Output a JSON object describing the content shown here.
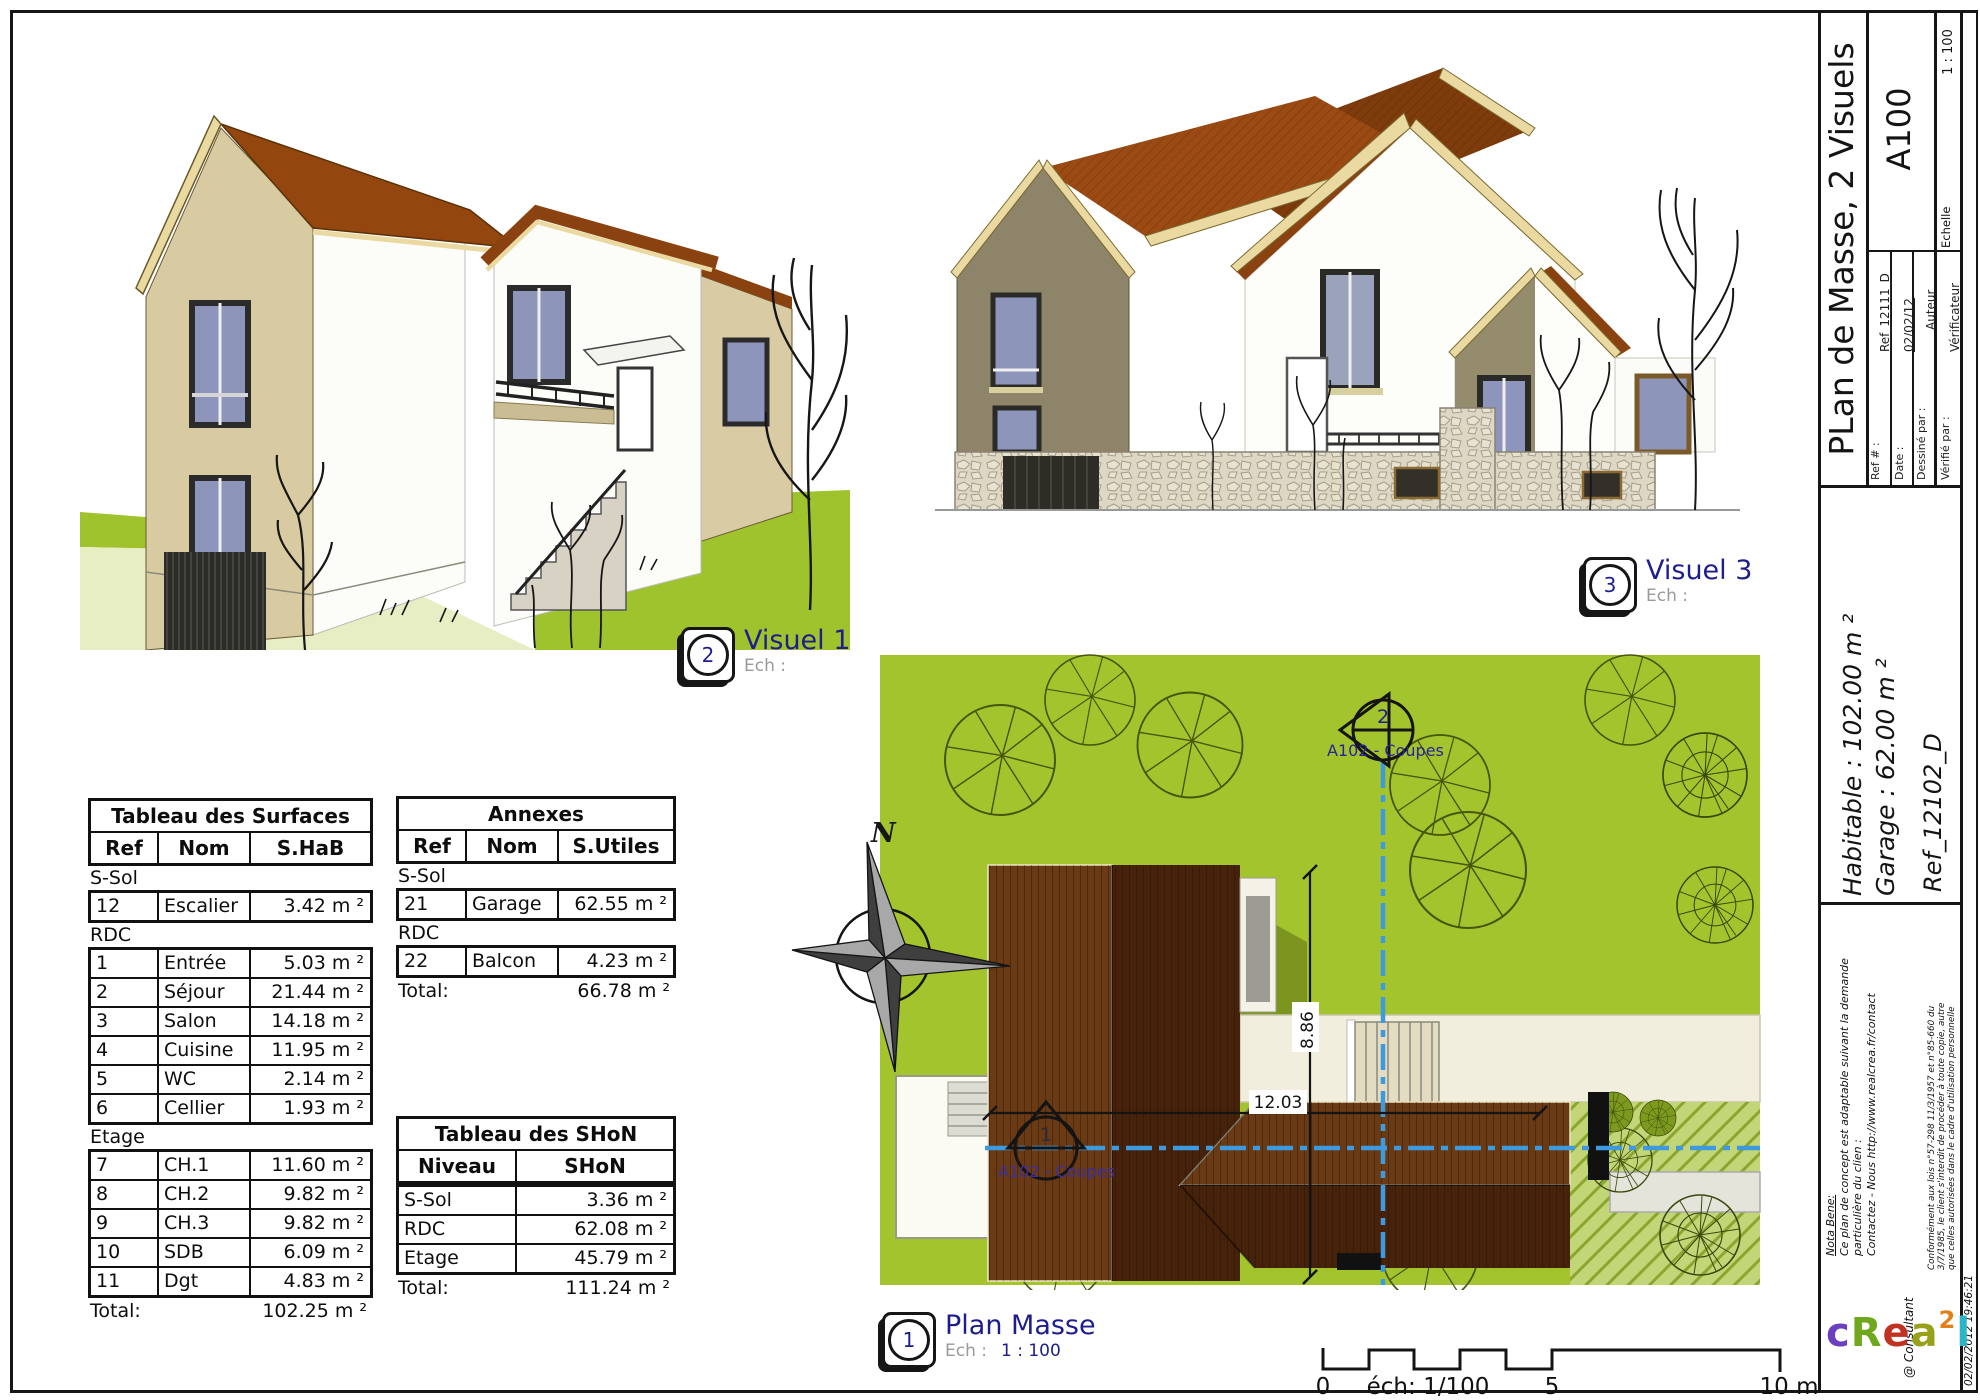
{
  "visual1": {
    "badge_num": "2",
    "title": "Visuel 1",
    "ech_label": "Ech :"
  },
  "visual3": {
    "badge_num": "3",
    "title": "Visuel 3",
    "ech_label": "Ech :"
  },
  "plan_label": {
    "badge_num": "1",
    "title": "Plan Masse",
    "ech_label": "Ech :",
    "scale": "1 : 100"
  },
  "plan": {
    "north": "N",
    "dim_vertical": "8.86",
    "dim_horizontal": "12.03",
    "section_top": {
      "num": "2",
      "label": "A102 - Coupes"
    },
    "section_left": {
      "num": "1",
      "label": "A102 - Coupes"
    }
  },
  "scale_bar": {
    "zero": "0",
    "caption": "éch: 1/100",
    "five": "5",
    "ten": "10 m"
  },
  "tables": {
    "surfaces": {
      "title": "Tableau des Surfaces",
      "headers": [
        "Ref",
        "Nom",
        "S.HaB"
      ],
      "groups": [
        {
          "label": "S-Sol",
          "rows": [
            [
              "12",
              "Escalier",
              "3.42 m ²"
            ]
          ]
        },
        {
          "label": "RDC",
          "rows": [
            [
              "1",
              "Entrée",
              "5.03 m ²"
            ],
            [
              "2",
              "Séjour",
              "21.44 m ²"
            ],
            [
              "3",
              "Salon",
              "14.18 m ²"
            ],
            [
              "4",
              "Cuisine",
              "11.95 m ²"
            ],
            [
              "5",
              "WC",
              "2.14 m ²"
            ],
            [
              "6",
              "Cellier",
              "1.93 m ²"
            ]
          ]
        },
        {
          "label": "Etage",
          "rows": [
            [
              "7",
              "CH.1",
              "11.60 m ²"
            ],
            [
              "8",
              "CH.2",
              "9.82 m ²"
            ],
            [
              "9",
              "CH.3",
              "9.82 m ²"
            ],
            [
              "10",
              "SDB",
              "6.09 m ²"
            ],
            [
              "11",
              "Dgt",
              "4.83 m ²"
            ]
          ]
        }
      ],
      "total_label": "Total:",
      "total_value": "102.25 m ²"
    },
    "annexes": {
      "title": "Annexes",
      "headers": [
        "Ref",
        "Nom",
        "S.Utiles"
      ],
      "groups": [
        {
          "label": "S-Sol",
          "rows": [
            [
              "21",
              "Garage",
              "62.55 m ²"
            ]
          ]
        },
        {
          "label": "RDC",
          "rows": [
            [
              "22",
              "Balcon",
              "4.23 m ²"
            ]
          ]
        }
      ],
      "total_label": "Total:",
      "total_value": "66.78 m ²"
    },
    "shon": {
      "title": "Tableau des SHoN",
      "headers": [
        "Niveau",
        "SHoN"
      ],
      "rows": [
        [
          "S-Sol",
          "3.36 m ²"
        ],
        [
          "RDC",
          "62.08 m ²"
        ],
        [
          "Etage",
          "45.79 m ²"
        ]
      ],
      "total_label": "Total:",
      "total_value": "111.24 m ²"
    }
  },
  "title_block": {
    "sheet_title": "PLan de Masse, 2 Visuels",
    "sheet_code": "A100",
    "ref_label": "Ref # :",
    "ref_value": "Ref_12111_D",
    "date_label": "Date :",
    "date_value": "02/02/12",
    "drawn_label": "Dessiné par :",
    "drawn_value": "Auteur",
    "checked_label": "Vérifié par :",
    "checked_value": "Vérificateur",
    "scale_label": "Echelle",
    "scale_value": "1 : 100",
    "habitable": "Habitable :  102.00 m ²",
    "garage": "Garage : 62.00 m ²",
    "ref_plan": "Ref_12102_D",
    "nota_title": "Nota Bene:",
    "nota_line1": "Ce plan de concept est adaptable suivant la demande",
    "nota_line2": "particulière du clien :",
    "nota_line3": "Contactez - Nous http://www.realcrea.fr/contact",
    "consultant": "@ Consultant",
    "legal_line1": "Conformément aux lois n°57-298 11/3/1957 et n°85-660 du",
    "legal_line2": "3/7/1985, le client s'interdit de procéder à toute copie, autre",
    "legal_line3": "que celles autorisées dans le cadre d'utilisation personnelle",
    "timestamp": "02/02/2012 19:46:21",
    "logo_letters": [
      "c",
      "R",
      "e",
      "a",
      "2",
      "l"
    ]
  },
  "colors": {
    "lawn_green": "#a4c42d",
    "roof_brown_light": "#6a3a15",
    "roof_brown_dark": "#46220a",
    "label_navy": "#1d1d8f",
    "section_blue": "#3d9ade",
    "ech_gray": "#9a9a9a"
  }
}
